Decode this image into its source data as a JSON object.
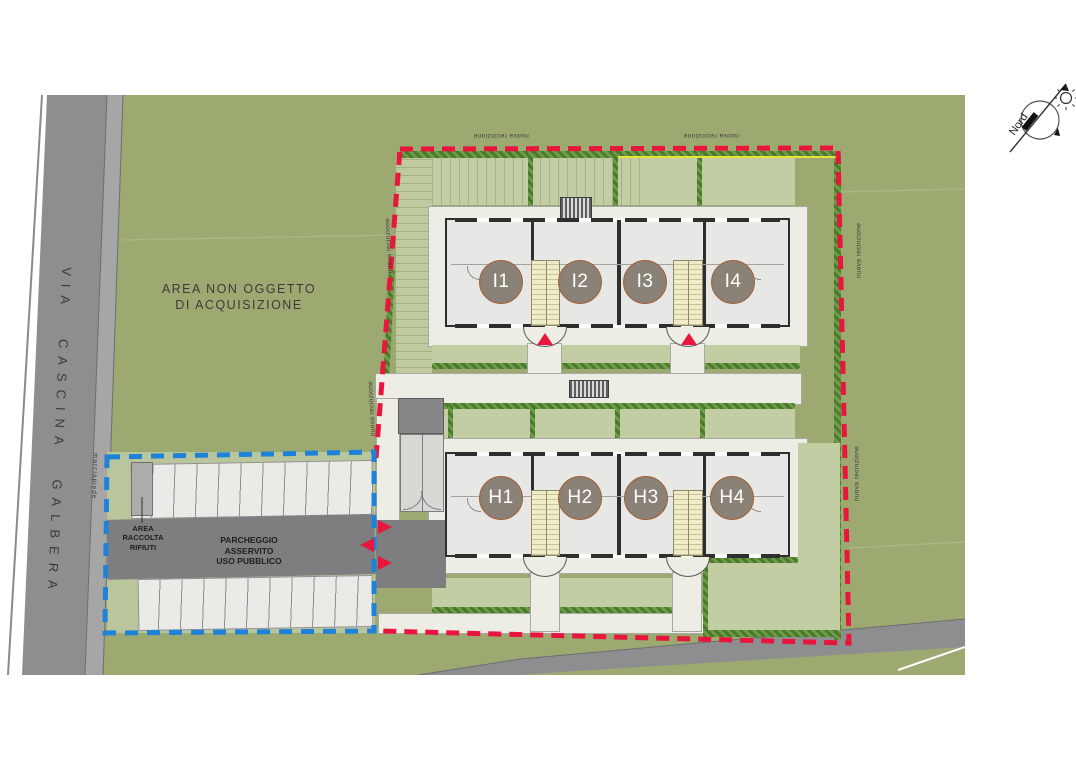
{
  "site": {
    "region_label": {
      "line1": "AREA NON OGGETTO",
      "line2": "DI ACQUISIZIONE"
    },
    "street_name": "VIA CASCINA GALBERA",
    "sidewalk_label": "marciapiede",
    "fence_label": "nuova recinzione",
    "compass_label": "Nord"
  },
  "parking": {
    "waste_label": {
      "line1": "AREA",
      "line2": "RACCOLTA",
      "line3": "RIFIUTI"
    },
    "public_label": {
      "line1": "PARCHEGGIO",
      "line2": "ASSERVITO",
      "line3": "USO PUBBLICO"
    },
    "top_row_stalls": 11,
    "bottom_row_stalls": 10
  },
  "buildings": {
    "block_i": {
      "units": [
        {
          "label": "I1"
        },
        {
          "label": "I2"
        },
        {
          "label": "I3"
        },
        {
          "label": "I4"
        }
      ]
    },
    "block_h": {
      "units": [
        {
          "label": "H1"
        },
        {
          "label": "H2"
        },
        {
          "label": "H3"
        },
        {
          "label": "H4"
        }
      ]
    }
  },
  "legend_colors": {
    "acquisition_boundary_red": "#E8163C",
    "public_parking_boundary_blue": "#1E82D9",
    "field_green": "#9CAA72",
    "garden_green": "#C2CDA4",
    "hedge_green": "#5E8C3C",
    "road_gray": "#8E8E90",
    "paving_gray": "#EDECE5",
    "unit_circle_fill": "#8A8177",
    "unit_circle_border": "#A35B2E",
    "stair_yellow": "#F0ECC8"
  }
}
